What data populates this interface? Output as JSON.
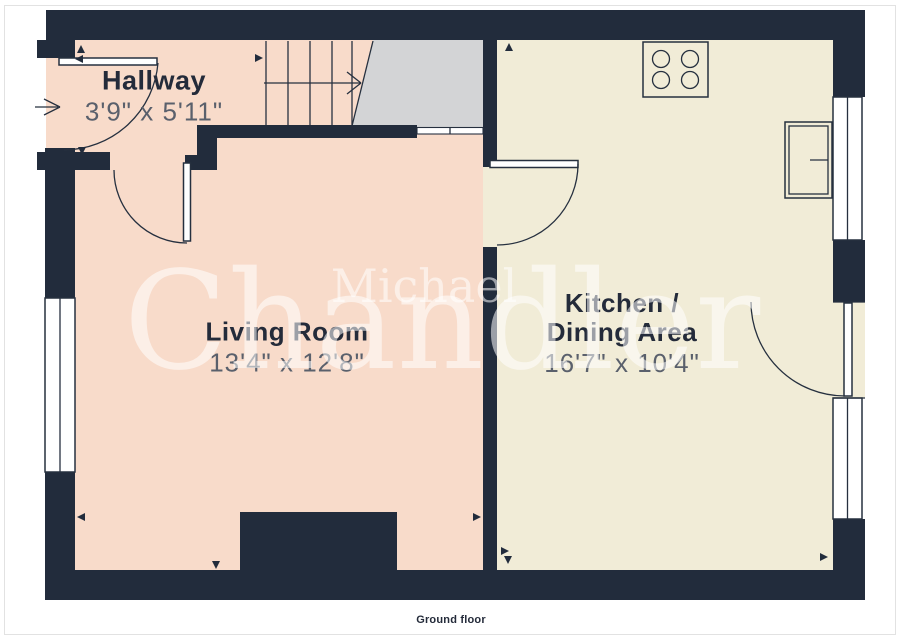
{
  "page": {
    "caption": "Ground floor"
  },
  "watermark": {
    "line1": "Michael",
    "line2": "Chandler"
  },
  "rooms": {
    "hallway": {
      "name": "Hallway",
      "dimensions": "3'9\" x 5'11\""
    },
    "living_room": {
      "name": "Living Room",
      "dimensions": "13'4\" x 12'8\""
    },
    "kitchen": {
      "name_line1": "Kitchen /",
      "name_line2": "Dining Area",
      "dimensions": "16'7\" x 10'4\""
    }
  },
  "colors": {
    "wall": "#222c3c",
    "floor_warm": "#f8dbca",
    "floor_cream": "#f1ecd7",
    "floor_landing": "#d3d4d6",
    "line": "#26303f",
    "label_name": "#242b3a",
    "label_dims": "#5a606c",
    "watermark": "rgba(255,255,255,0.55)",
    "page_border": "#e2e2e2"
  }
}
